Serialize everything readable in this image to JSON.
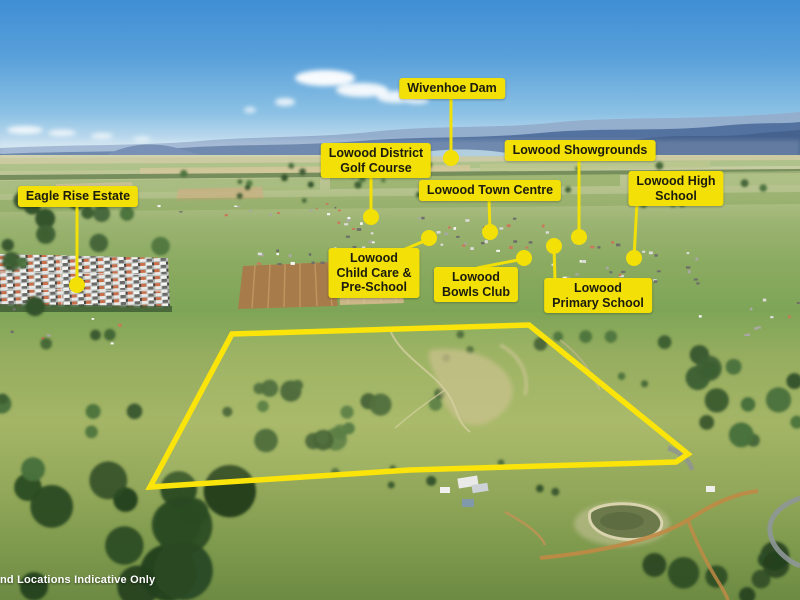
{
  "disclaimer": "nd Locations Indicative Only",
  "colors": {
    "label_bg": "#f2e006",
    "label_text": "#1c1c0e",
    "leader_line": "#f2e006",
    "location_dot": "#f2e006",
    "boundary": "#fbe40a",
    "disclaimer_text": "#ffffff",
    "sky_top": "#3f8ed4",
    "mountains": "#54729f"
  },
  "annotations": [
    {
      "id": "wivenhoe-dam",
      "text": "Wivenhoe Dam",
      "label": {
        "cx": 452,
        "top": 78
      },
      "leader": {
        "x1": 451,
        "y1": 96,
        "x2": 451,
        "y2": 158
      },
      "dot": {
        "x": 451,
        "y": 158,
        "r": 8
      }
    },
    {
      "id": "lowood-district-golf-course",
      "text": "Lowood District\nGolf Course",
      "label": {
        "cx": 376,
        "top": 143
      },
      "leader": {
        "x1": 371,
        "y1": 174,
        "x2": 371,
        "y2": 217
      },
      "dot": {
        "x": 371,
        "y": 217,
        "r": 8
      }
    },
    {
      "id": "lowood-showgrounds",
      "text": "Lowood Showgrounds",
      "label": {
        "cx": 580,
        "top": 140
      },
      "leader": {
        "x1": 579,
        "y1": 158,
        "x2": 579,
        "y2": 237
      },
      "dot": {
        "x": 579,
        "y": 237,
        "r": 8
      }
    },
    {
      "id": "lowood-town-centre",
      "text": "Lowood Town Centre",
      "label": {
        "cx": 490,
        "top": 180
      },
      "leader": {
        "x1": 489,
        "y1": 198,
        "x2": 490,
        "y2": 232
      },
      "dot": {
        "x": 490,
        "y": 232,
        "r": 8
      }
    },
    {
      "id": "lowood-high-school",
      "text": "Lowood High\nSchool",
      "label": {
        "cx": 676,
        "top": 171
      },
      "leader": {
        "x1": 637,
        "y1": 202,
        "x2": 634,
        "y2": 258
      },
      "dot": {
        "x": 634,
        "y": 258,
        "r": 8
      }
    },
    {
      "id": "eagle-rise-estate",
      "text": "Eagle Rise Estate",
      "label": {
        "cx": 78,
        "top": 186
      },
      "leader": {
        "x1": 77,
        "y1": 200,
        "x2": 77,
        "y2": 285
      },
      "dot": {
        "x": 77,
        "y": 285,
        "r": 8
      }
    },
    {
      "id": "lowood-child-care-pre-school",
      "text": "Lowood\nChild Care &\nPre-School",
      "label": {
        "cx": 374,
        "top": 248
      },
      "leader": {
        "x1": 403,
        "y1": 250,
        "x2": 429,
        "y2": 239
      },
      "dot": {
        "x": 429,
        "y": 238,
        "r": 8
      }
    },
    {
      "id": "lowood-bowls-club",
      "text": "Lowood\nBowls Club",
      "label": {
        "cx": 476,
        "top": 267
      },
      "leader": {
        "x1": 477,
        "y1": 268,
        "x2": 523,
        "y2": 259
      },
      "dot": {
        "x": 524,
        "y": 258,
        "r": 8
      }
    },
    {
      "id": "lowood-primary-school",
      "text": "Lowood\nPrimary School",
      "label": {
        "cx": 598,
        "top": 278
      },
      "leader": {
        "x1": 555,
        "y1": 280,
        "x2": 554,
        "y2": 247
      },
      "dot": {
        "x": 554,
        "y": 246,
        "r": 8
      }
    }
  ],
  "property_boundary": {
    "points": [
      [
        232,
        334
      ],
      [
        529,
        325
      ],
      [
        688,
        454
      ],
      [
        676,
        462
      ],
      [
        410,
        470
      ],
      [
        150,
        487
      ]
    ],
    "stroke_width": 5.5
  }
}
